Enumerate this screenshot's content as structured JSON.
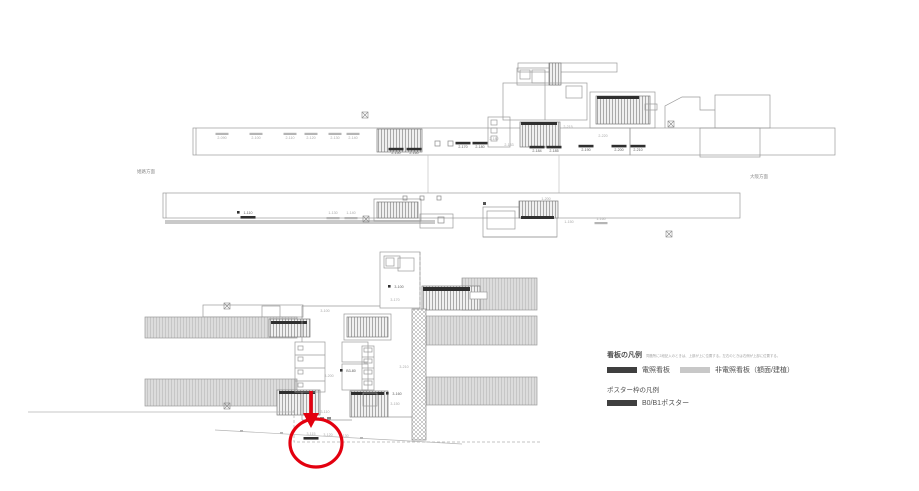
{
  "colors": {
    "annotation_red": "#e3000f",
    "line_gray": "#9a9a9a",
    "sign_black": "#2f2f2f",
    "sign_gray": "#b5b5b5",
    "platform_fill": "#dcdcdc",
    "legend_dark_swatch": "#3f3f3f",
    "legend_light_swatch": "#c8c8c8"
  },
  "direction_labels": {
    "left": "姫路方面",
    "right": "大阪方面"
  },
  "legend": {
    "signboard_heading": "看板の凡例",
    "signboard_note": "同箇所に2段記入のときは、上部が上に位置する。左右のときは右側が上部に位置する。",
    "items": [
      {
        "label": "電照看板",
        "color": "#3f3f3f"
      },
      {
        "label": "非電照看板（額面/建植）",
        "color": "#c8c8c8"
      }
    ],
    "poster_heading": "ポスター枠の凡例",
    "poster_items": [
      {
        "label": "B0/B1ポスター",
        "color": "#3f3f3f"
      }
    ]
  },
  "annotation": {
    "target": "3-115",
    "color": "#e3000f"
  },
  "plans": {
    "top": {
      "marks": [
        {
          "t": "2-090",
          "x": 222,
          "y": 139,
          "c": "g",
          "bar": "g"
        },
        {
          "t": "2-100",
          "x": 256,
          "y": 139,
          "c": "g",
          "bar": "g"
        },
        {
          "t": "2-110",
          "x": 290,
          "y": 139,
          "c": "g",
          "bar": "g"
        },
        {
          "t": "2-120",
          "x": 311,
          "y": 139,
          "c": "g",
          "bar": "g"
        },
        {
          "t": "2-130",
          "x": 335,
          "y": 139,
          "c": "g",
          "bar": "g"
        },
        {
          "t": "2-140",
          "x": 353,
          "y": 139,
          "c": "g",
          "bar": "g"
        },
        {
          "t": "2-150",
          "x": 396,
          "y": 154,
          "c": "d",
          "bar": "b"
        },
        {
          "t": "2-160",
          "x": 414,
          "y": 154,
          "c": "d",
          "bar": "b"
        },
        {
          "t": "2-170",
          "x": 463,
          "y": 148,
          "c": "d",
          "bar": "b"
        },
        {
          "t": "2-180",
          "x": 480,
          "y": 148,
          "c": "d",
          "bar": "b"
        },
        {
          "t": "2-182",
          "x": 494,
          "y": 140,
          "c": "g"
        },
        {
          "t": "2-183",
          "x": 509,
          "y": 146,
          "c": "g"
        },
        {
          "t": "2-184",
          "x": 537,
          "y": 152,
          "c": "d",
          "bar": "b"
        },
        {
          "t": "2-185",
          "x": 554,
          "y": 152,
          "c": "d",
          "bar": "b"
        },
        {
          "t": "2-215",
          "x": 568,
          "y": 128,
          "c": "g"
        },
        {
          "t": "2-220",
          "x": 603,
          "y": 137,
          "c": "g"
        },
        {
          "t": "2-190",
          "x": 586,
          "y": 151,
          "c": "d",
          "bar": "b"
        },
        {
          "t": "2-200",
          "x": 619,
          "y": 151,
          "c": "d",
          "bar": "b"
        },
        {
          "t": "2-210",
          "x": 638,
          "y": 151,
          "c": "d",
          "bar": "b"
        }
      ]
    },
    "middle": {
      "marks": [
        {
          "t": "1-110",
          "x": 248,
          "y": 214,
          "c": "d",
          "sq": true,
          "bar": "b",
          "bdy": 2
        },
        {
          "t": "1-130",
          "x": 333,
          "y": 214,
          "c": "g",
          "bar": "g",
          "bdy": 3
        },
        {
          "t": "1-140",
          "x": 351,
          "y": 214,
          "c": "g",
          "bar": "g",
          "bdy": 3
        },
        {
          "t": "1-200",
          "x": 546,
          "y": 200,
          "c": "g"
        },
        {
          "t": "1-150",
          "x": 569,
          "y": 223,
          "c": "g"
        },
        {
          "t": "1-160",
          "x": 601,
          "y": 220,
          "c": "g",
          "bar": "g",
          "bdy": 2
        }
      ]
    },
    "bottom": {
      "marks": [
        {
          "t": "3-100",
          "x": 325,
          "y": 312,
          "c": "g"
        },
        {
          "t": "3-100",
          "x": 399,
          "y": 288,
          "c": "d",
          "sq": true
        },
        {
          "t": "3-170",
          "x": 395,
          "y": 301,
          "c": "g"
        },
        {
          "t": "3-200",
          "x": 329,
          "y": 377,
          "c": "g"
        },
        {
          "t": "B3-80",
          "x": 351,
          "y": 372,
          "c": "d",
          "sq": true
        },
        {
          "t": "3-210",
          "x": 404,
          "y": 368,
          "c": "g"
        },
        {
          "t": "3-160",
          "x": 397,
          "y": 395,
          "c": "d",
          "sq": true
        },
        {
          "t": "3-150",
          "x": 395,
          "y": 405,
          "c": "g"
        },
        {
          "t": "3-110",
          "x": 325,
          "y": 413,
          "c": "g"
        },
        {
          "t": "3-115",
          "x": 311,
          "y": 435,
          "c": "g",
          "bar": "b",
          "bdy": 2
        },
        {
          "t": "3-120",
          "x": 328,
          "y": 436,
          "c": "g"
        },
        {
          "t": "3-130",
          "x": 344,
          "y": 437,
          "c": "g"
        }
      ]
    }
  }
}
